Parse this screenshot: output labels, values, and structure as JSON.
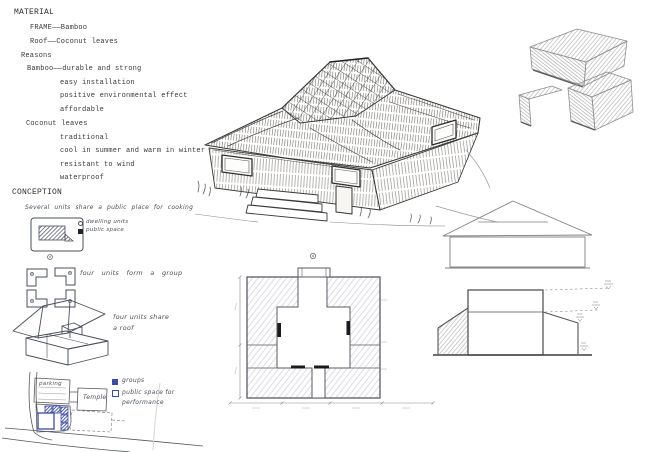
{
  "colors": {
    "ink": "#3a3a3a",
    "pencil": "#9a9a9a",
    "handwriting": "#4b4f5e",
    "blue": "#3b4da6"
  },
  "typed": {
    "lines": [
      {
        "text": "MATERIAL"
      },
      {
        "text": "FRAME——Bamboo"
      },
      {
        "text": "Roof——Coconut leaves"
      },
      {
        "text": "Reasons"
      },
      {
        "text": "Bamboo——durable and strong"
      },
      {
        "text": "easy installation"
      },
      {
        "text": "positive environmental effect"
      },
      {
        "text": "affordable"
      },
      {
        "text": "Coconut leaves"
      },
      {
        "text": "traditional"
      },
      {
        "text": "cool in summer and warm in winter"
      },
      {
        "text": "resistant to wind"
      },
      {
        "text": "waterproof"
      },
      {
        "text": "CONCEPTION"
      }
    ]
  },
  "hand": {
    "cooking_note": "Several units share a public place for cooking",
    "legend_dwelling": "dwelling units",
    "legend_public": "public space",
    "group_note": "four units form a group",
    "roof_note": "four units share a roof",
    "site_groups": "groups",
    "site_public": "public space for performance",
    "parking": "parking",
    "temple": "Temple"
  }
}
